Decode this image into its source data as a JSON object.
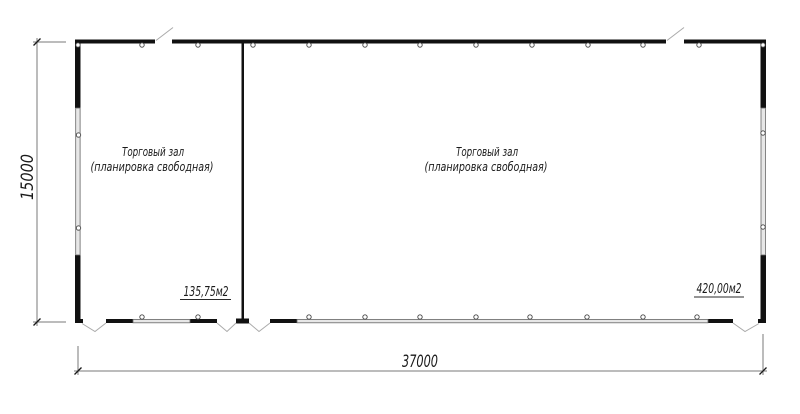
{
  "drawing": {
    "type": "floor-plan",
    "left_room": {
      "title": "Торговый зал",
      "subtitle": "(планировка свободная)",
      "area": "135,75м2"
    },
    "right_room": {
      "title": "Торговый зал",
      "subtitle": "(планировка свободная)",
      "area": "420,00м2"
    },
    "dimensions": {
      "height": "15000",
      "width": "37000"
    },
    "colors": {
      "wall": "#111111",
      "window_band": "#e7e7e7",
      "window_outline": "#666666",
      "dimension_line": "#787878",
      "door_line": "#aaaaaa",
      "text": "#1a1a1a",
      "background": "#ffffff"
    }
  }
}
